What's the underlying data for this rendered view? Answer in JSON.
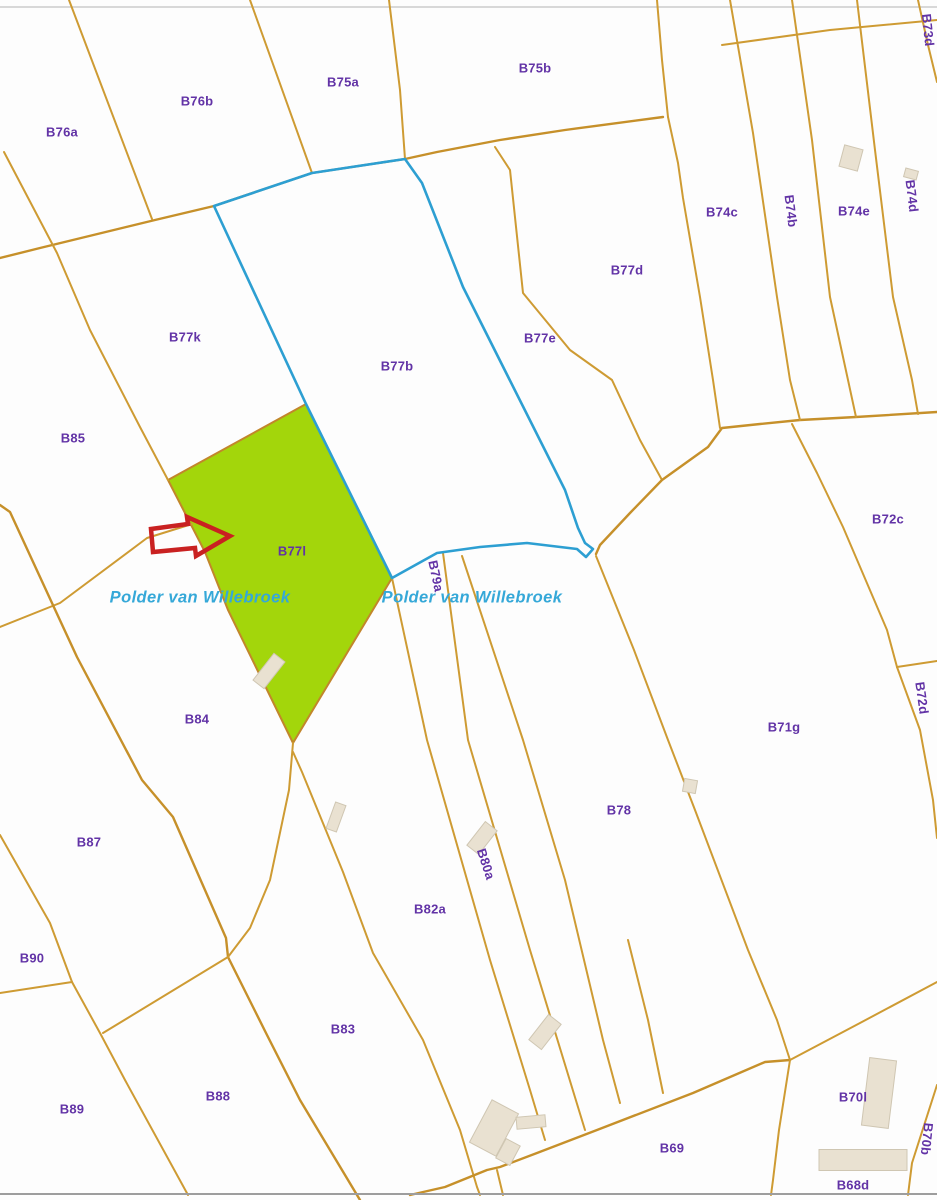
{
  "map": {
    "title": "Cadastral parcel map",
    "colors": {
      "background": "#FDFDFD",
      "parcel_line": "#CE9B33",
      "road_line": "#C6902A",
      "blue_boundary": "#2D9FD2",
      "highlight_fill": "#A3D60B",
      "highlight_stroke": "#C2862B",
      "label_text": "#6233A6",
      "water_text": "#35A8D8",
      "arrow": "#C92121",
      "building_fill": "#E9E1D1",
      "building_stroke": "#CFC6B2",
      "border_top": "#CCCCCC",
      "border_bottom": "#9D9D9D"
    },
    "highlighted_parcel": "B77l",
    "water_labels": [
      {
        "text": "Polder van Willebroek",
        "x": 200,
        "y": 598
      },
      {
        "text": "Polder van Willebroek",
        "x": 472,
        "y": 598
      }
    ],
    "parcels": [
      {
        "label": "B76a",
        "x": 62,
        "y": 132,
        "rot": 0
      },
      {
        "label": "B76b",
        "x": 197,
        "y": 101,
        "rot": 0
      },
      {
        "label": "B75a",
        "x": 343,
        "y": 82,
        "rot": 0
      },
      {
        "label": "B75b",
        "x": 535,
        "y": 68,
        "rot": 0
      },
      {
        "label": "B73d",
        "x": 928,
        "y": 30,
        "rot": 84
      },
      {
        "label": "B74c",
        "x": 722,
        "y": 212,
        "rot": 0
      },
      {
        "label": "B74b",
        "x": 791,
        "y": 211,
        "rot": 83
      },
      {
        "label": "B74e",
        "x": 854,
        "y": 211,
        "rot": 0
      },
      {
        "label": "B74d",
        "x": 912,
        "y": 196,
        "rot": 83
      },
      {
        "label": "B77d",
        "x": 627,
        "y": 270,
        "rot": 0
      },
      {
        "label": "B77k",
        "x": 185,
        "y": 337,
        "rot": 0
      },
      {
        "label": "B77b",
        "x": 397,
        "y": 366,
        "rot": 0
      },
      {
        "label": "B77e",
        "x": 540,
        "y": 338,
        "rot": 0
      },
      {
        "label": "B85",
        "x": 73,
        "y": 438,
        "rot": 0
      },
      {
        "label": "B72c",
        "x": 888,
        "y": 519,
        "rot": 0
      },
      {
        "label": "B77l",
        "x": 292,
        "y": 551,
        "rot": 0
      },
      {
        "label": "B79a",
        "x": 436,
        "y": 576,
        "rot": 78
      },
      {
        "label": "B72d",
        "x": 922,
        "y": 698,
        "rot": 82
      },
      {
        "label": "B84",
        "x": 197,
        "y": 719,
        "rot": 0
      },
      {
        "label": "B71g",
        "x": 784,
        "y": 727,
        "rot": 0
      },
      {
        "label": "B78",
        "x": 619,
        "y": 810,
        "rot": 0
      },
      {
        "label": "B87",
        "x": 89,
        "y": 842,
        "rot": 0
      },
      {
        "label": "B80a",
        "x": 486,
        "y": 864,
        "rot": 72
      },
      {
        "label": "B82a",
        "x": 430,
        "y": 909,
        "rot": 0
      },
      {
        "label": "B90",
        "x": 32,
        "y": 958,
        "rot": 0
      },
      {
        "label": "B83",
        "x": 343,
        "y": 1029,
        "rot": 0
      },
      {
        "label": "B88",
        "x": 218,
        "y": 1096,
        "rot": 0
      },
      {
        "label": "B89",
        "x": 72,
        "y": 1109,
        "rot": 0
      },
      {
        "label": "B70l",
        "x": 853,
        "y": 1097,
        "rot": 0
      },
      {
        "label": "B70b",
        "x": 927,
        "y": 1139,
        "rot": 96
      },
      {
        "label": "B69",
        "x": 672,
        "y": 1148,
        "rot": 0
      },
      {
        "label": "B68d",
        "x": 853,
        "y": 1185,
        "rot": 0
      }
    ],
    "highlight_polygon": "168,480 306,404 392,578 293,743 228,610 205,552",
    "blue_boundary_path": "M214,206 L312,173 L405,159 L422,183 L463,287 L565,490 L578,528 L585,543 L593,549 L586,557 L577,549 L527,543 L480,547 L437,553 L392,578 L306,404 Z",
    "arrow_polygon": "151,529 188,524 187,517 230,536 196,556 195,548 153,552",
    "lines": [
      {
        "name": "border-top",
        "type": "border-top",
        "d": "M0,7 L937,7"
      },
      {
        "name": "road-north",
        "type": "road",
        "d": "M0,258 L40,248 L155,220 L214,206 L312,173 L405,159 L437,152 L500,140 L565,130 L663,117"
      },
      {
        "name": "boundary-b76a-b76b",
        "type": "line",
        "d": "M69,0 L152,219"
      },
      {
        "name": "boundary-b76b-b75a",
        "type": "line",
        "d": "M250,0 L312,173"
      },
      {
        "name": "boundary-b75a-b75b",
        "type": "line",
        "d": "M389,0 L400,90 L405,159"
      },
      {
        "name": "boundary-west-upper",
        "type": "line",
        "d": "M4,152 L57,253 L90,330 L140,427 L168,480"
      },
      {
        "name": "boundary-b75b-east",
        "type": "line",
        "d": "M657,0 L662,60 L668,117"
      },
      {
        "name": "boundary-b77e-b77d",
        "type": "line",
        "d": "M495,147 L510,170 L523,293 L570,350 L612,380 L640,440 L662,480"
      },
      {
        "name": "boundary-b77d-b74c",
        "type": "line",
        "d": "M668,117 L678,163 L683,198 L700,297 L713,380 L720,428"
      },
      {
        "name": "road-middle",
        "type": "road",
        "d": "M596,554 L600,545 L630,513 L662,480 L708,447 L722,428 L760,424 L800,420 L856,417 L937,412"
      },
      {
        "name": "strip-b74c-b74b",
        "type": "line",
        "d": "M730,0 L753,133 L777,297 L790,380 L800,420"
      },
      {
        "name": "strip-b74b-b74e",
        "type": "line",
        "d": "M792,0 L812,140 L830,297 L848,380 L856,417"
      },
      {
        "name": "strip-b74e-b74d",
        "type": "line",
        "d": "M857,0 L875,150 L893,297 L912,380 L918,414"
      },
      {
        "name": "strip-b74d-b73d",
        "type": "line",
        "d": "M918,0 L928,45 L937,82"
      },
      {
        "name": "cross-top-right",
        "type": "line",
        "d": "M722,45 L830,30 L937,20"
      },
      {
        "name": "boundary-b72c-west",
        "type": "line",
        "d": "M792,424 L817,473 L843,527 L887,630 L897,667"
      },
      {
        "name": "boundary-b72c-b72d",
        "type": "line",
        "d": "M897,667 L937,661"
      },
      {
        "name": "boundary-b72d-west",
        "type": "line",
        "d": "M897,667 L920,730 L933,800 L937,838"
      },
      {
        "name": "road-b85-b84",
        "type": "line",
        "d": "M0,627 L60,603 L147,538 L192,524"
      },
      {
        "name": "boundary-west-long",
        "type": "road",
        "d": "M0,505 L10,512 L52,603 L77,657 L142,780 L173,817 L226,938 L228,957 L267,1035 L300,1100 L360,1200"
      },
      {
        "name": "boundary-b87-west",
        "type": "line",
        "d": "M0,835 L4,842 L50,923 L72,982 L100,1033 L125,1080 L188,1195"
      },
      {
        "name": "stub-b90",
        "type": "line",
        "d": "M0,993 L72,982"
      },
      {
        "name": "boundary-b87-b88",
        "type": "line",
        "d": "M228,957 L103,1033"
      },
      {
        "name": "boundary-b84-east",
        "type": "line",
        "d": "M293,743 L289,790 L270,880 L250,928 L228,957"
      },
      {
        "name": "boundary-b82a-west",
        "type": "line",
        "d": "M293,752 L302,772 L343,872 L373,953 L423,1040 L460,1130 L477,1187 L480,1195"
      },
      {
        "name": "strip-b79a-west",
        "type": "line",
        "d": "M392,578 L427,740 L490,960 L530,1090 L545,1140"
      },
      {
        "name": "strip-b79a-east",
        "type": "line",
        "d": "M443,553 L468,740 L530,950 L585,1130"
      },
      {
        "name": "strip-b80a-east",
        "type": "line",
        "d": "M462,556 L523,740 L565,880 L603,1040 L620,1103"
      },
      {
        "name": "strip-short-lower",
        "type": "line",
        "d": "M628,940 L648,1020 L663,1093"
      },
      {
        "name": "boundary-b78-b71g",
        "type": "line",
        "d": "M596,556 L634,650 L668,740 L695,810 L748,950 L777,1020 L790,1060"
      },
      {
        "name": "boundary-b69-north",
        "type": "road",
        "d": "M790,1060 L765,1062 L693,1093 L597,1130 L537,1153 L500,1167 L487,1170 L445,1187 L410,1195"
      },
      {
        "name": "boundary-b69-b68d",
        "type": "line",
        "d": "M790,1060 L779,1130 L773,1180 L771,1195"
      },
      {
        "name": "boundary-b71g-b70l",
        "type": "line",
        "d": "M790,1060 L860,1023 L937,982"
      },
      {
        "name": "boundary-b70l-b70b",
        "type": "line",
        "d": "M937,1085 L912,1163 L908,1195"
      },
      {
        "name": "stub-bottom-center",
        "type": "line",
        "d": "M497,1170 L503,1195"
      },
      {
        "name": "border-bottom",
        "type": "border-bottom",
        "d": "M0,1194 L937,1194"
      }
    ],
    "buildings": [
      {
        "cx": 851,
        "cy": 158,
        "w": 19,
        "h": 22,
        "rot": 15
      },
      {
        "cx": 911,
        "cy": 174,
        "w": 13,
        "h": 9,
        "rot": 15
      },
      {
        "cx": 269,
        "cy": 671,
        "w": 14,
        "h": 34,
        "rot": 38
      },
      {
        "cx": 336,
        "cy": 817,
        "w": 11,
        "h": 28,
        "rot": 20
      },
      {
        "cx": 482,
        "cy": 838,
        "w": 15,
        "h": 30,
        "rot": 38
      },
      {
        "cx": 690,
        "cy": 786,
        "w": 13,
        "h": 13,
        "rot": 10
      },
      {
        "cx": 545,
        "cy": 1032,
        "w": 16,
        "h": 32,
        "rot": 38
      },
      {
        "cx": 494,
        "cy": 1128,
        "w": 30,
        "h": 48,
        "rot": 28
      },
      {
        "cx": 508,
        "cy": 1152,
        "w": 16,
        "h": 22,
        "rot": 28
      },
      {
        "cx": 531,
        "cy": 1122,
        "w": 29,
        "h": 12,
        "rot": -5
      },
      {
        "cx": 879,
        "cy": 1093,
        "w": 27,
        "h": 68,
        "rot": 7
      },
      {
        "cx": 863,
        "cy": 1160,
        "w": 88,
        "h": 21,
        "rot": 0
      }
    ]
  }
}
